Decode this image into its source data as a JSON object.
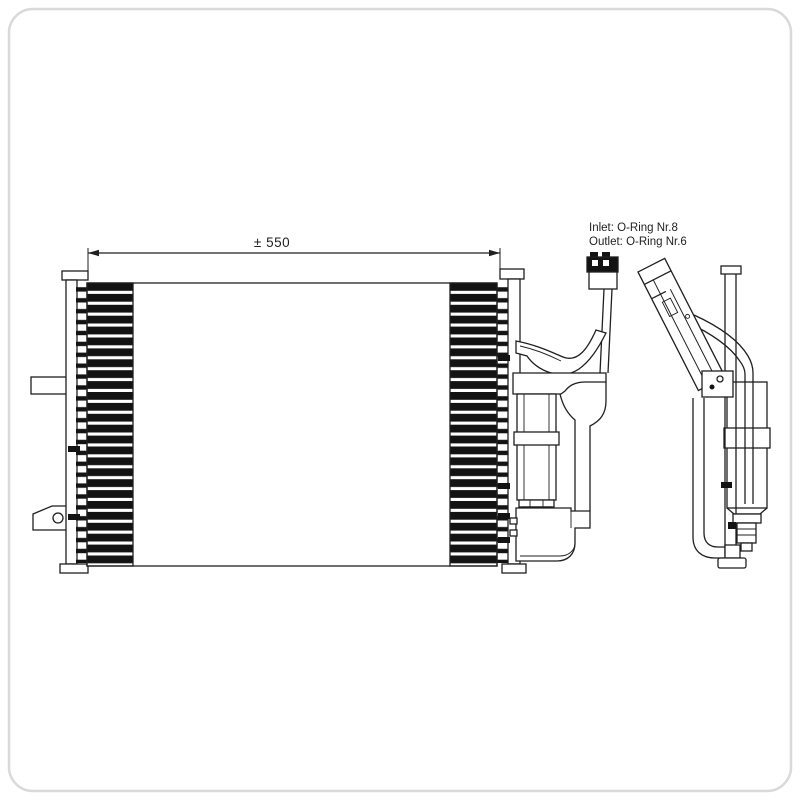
{
  "annotations": {
    "width_dimension": "± 550",
    "height_dimension": "± 383",
    "fitting_note_line1": "Inlet: O-Ring Nr.8",
    "fitting_note_line2": "Outlet: O-Ring Nr.6"
  },
  "colors": {
    "line": "#1f1f1f",
    "background": "#ffffff",
    "core_dark": "#131313",
    "frame_border": "#d9d9d9"
  }
}
